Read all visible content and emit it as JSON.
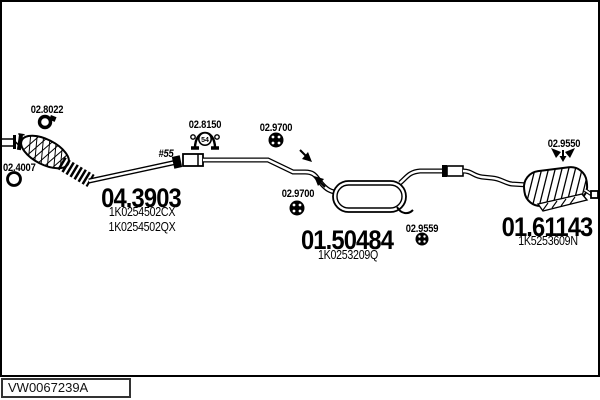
{
  "footer": {
    "catalog_code": "VW0067239A"
  },
  "colors": {
    "ink": "#000000",
    "paper": "#ffffff"
  },
  "diagram": {
    "pipe_note": "#55",
    "clamp_badge": "54",
    "refs": {
      "front_gasket": "02.8022",
      "front_ring": "02.4007",
      "pipe_clamp": "02.8150",
      "hanger_a": "02.9700",
      "hanger_b": "02.9700",
      "hanger_c": "02.9559",
      "rear_bracket": "02.9550"
    },
    "parts": {
      "front_pipe_cat": {
        "code": "04.3903",
        "oem1": "1K0254502CX",
        "oem2": "1K0254502QX"
      },
      "centre_muffler": {
        "code": "01.50484",
        "oem1": "1K0253209Q"
      },
      "rear_muffler": {
        "code": "01.61143",
        "oem1": "1K5253609N"
      }
    }
  }
}
